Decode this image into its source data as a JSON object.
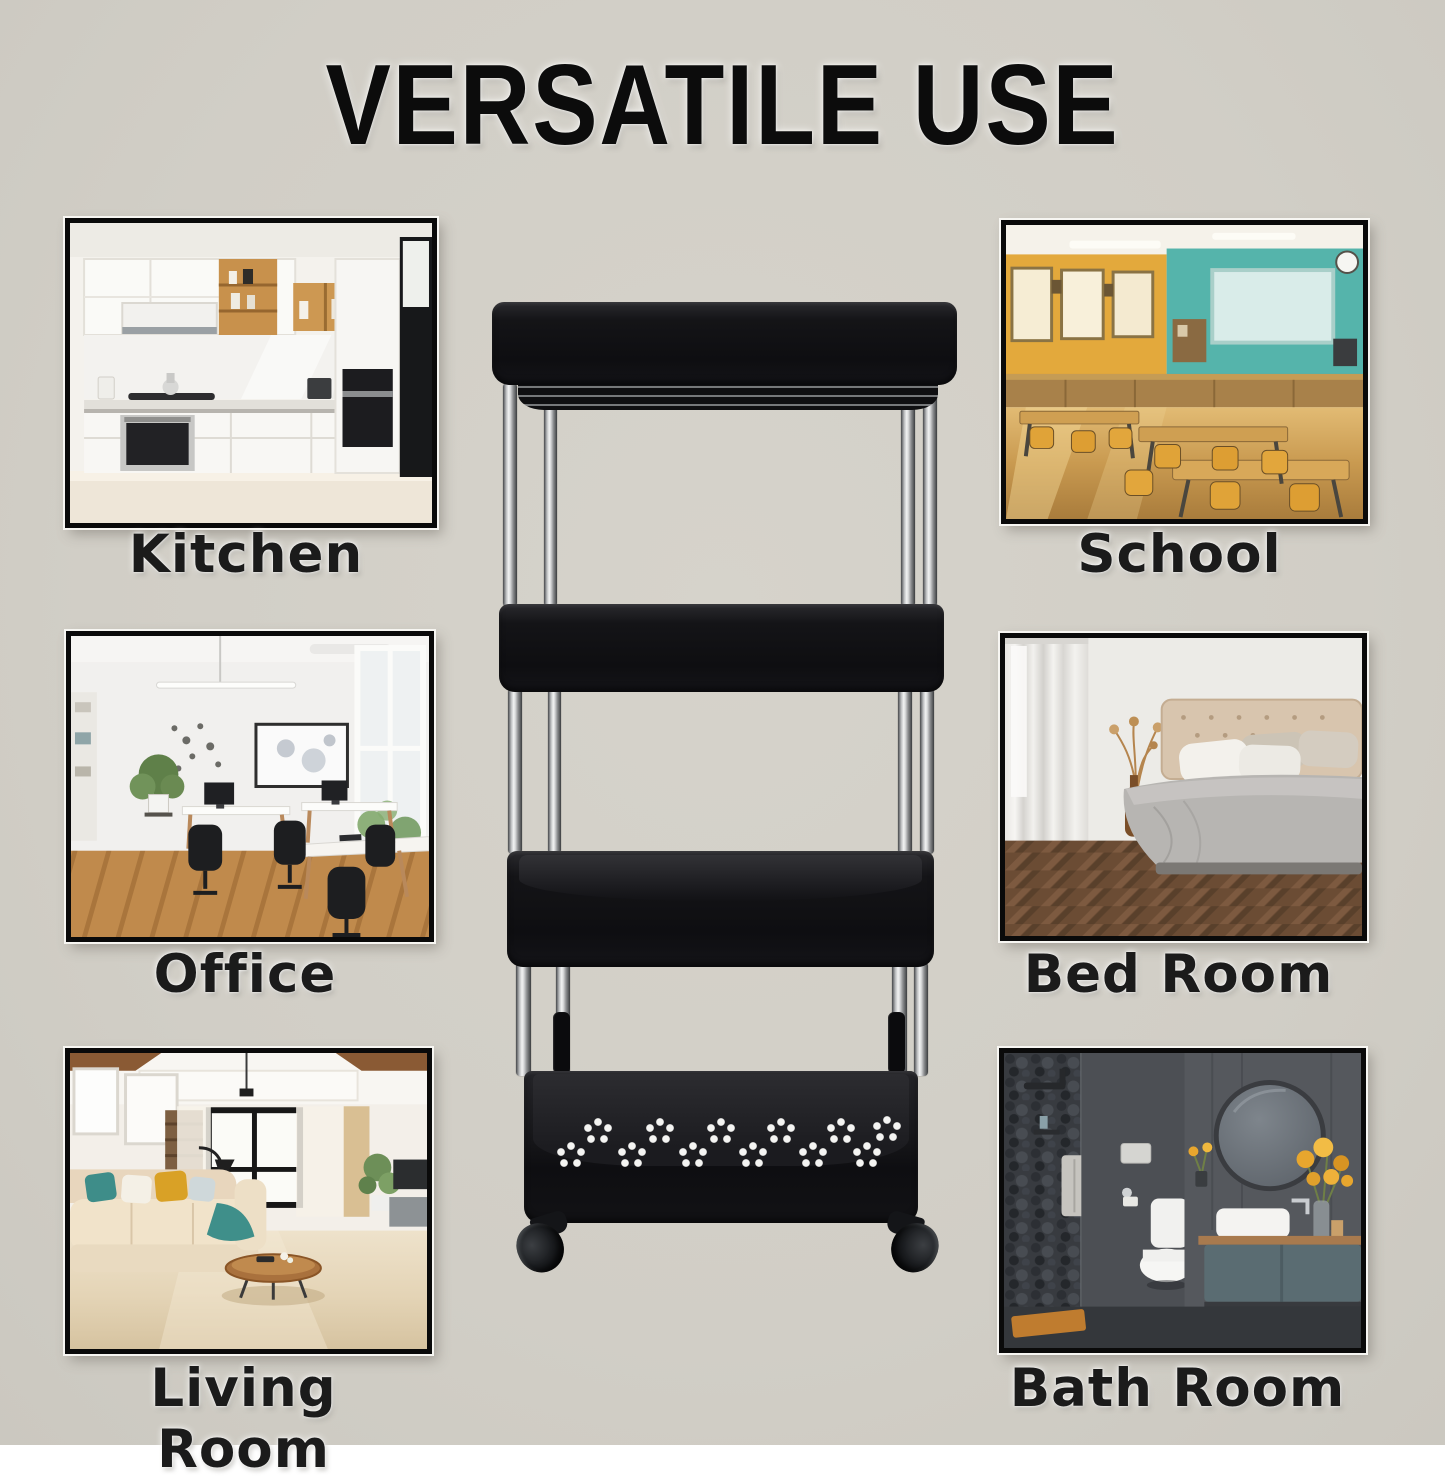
{
  "title": "VERSATILE USE",
  "theme": {
    "background": "#d1cec6",
    "title_ink": "#0c0c0c",
    "label_ink": "#1b1b1b",
    "frame_border": "#0a0a0a",
    "frame_outline": "#f7f6f2",
    "cart_black": "#121214",
    "chrome_highlight": "#f2f3f3"
  },
  "cart": {
    "tiers": 4,
    "body_color": "black",
    "pole_finish": "chrome",
    "visible_wheels": 2,
    "bottom_tray_perforations": "flower-hole-clusters"
  },
  "rooms": [
    {
      "id": "kitchen",
      "label": "Kitchen"
    },
    {
      "id": "school",
      "label": "School"
    },
    {
      "id": "office",
      "label": "Office"
    },
    {
      "id": "bedroom",
      "label": "Bed Room"
    },
    {
      "id": "living-room",
      "label": "Living Room"
    },
    {
      "id": "bathroom",
      "label": "Bath Room"
    }
  ]
}
